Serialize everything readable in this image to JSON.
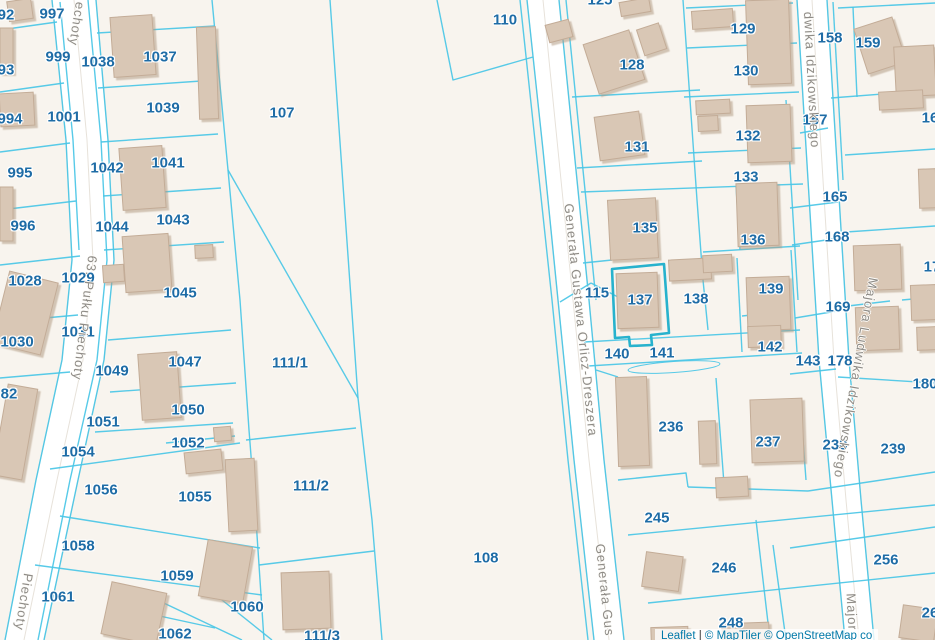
{
  "map": {
    "selected_parcel": "137",
    "colors": {
      "background": "#f8f4ee",
      "parcel_line": "#49c6e6",
      "selected_outline": "#27b2cd",
      "parcel_label": "#1e6ca6",
      "street_label": "#8e8b86",
      "building_fill": "#d9c7b5",
      "building_stroke": "#c3ac97",
      "road_fill": "#ffffff",
      "road_edge": "#d8d3cb"
    },
    "parcel_labels": [
      {
        "text": "92",
        "x": 6,
        "y": 15
      },
      {
        "text": "997",
        "x": 52,
        "y": 14
      },
      {
        "text": "999",
        "x": 58,
        "y": 57
      },
      {
        "text": "1038",
        "x": 98,
        "y": 62
      },
      {
        "text": "1037",
        "x": 160,
        "y": 57
      },
      {
        "text": "93",
        "x": 6,
        "y": 70
      },
      {
        "text": "1001",
        "x": 64,
        "y": 117
      },
      {
        "text": "994",
        "x": 10,
        "y": 119
      },
      {
        "text": "1039",
        "x": 163,
        "y": 108
      },
      {
        "text": "995",
        "x": 20,
        "y": 173
      },
      {
        "text": "1042",
        "x": 107,
        "y": 168
      },
      {
        "text": "1041",
        "x": 168,
        "y": 163
      },
      {
        "text": "996",
        "x": 23,
        "y": 226
      },
      {
        "text": "1044",
        "x": 112,
        "y": 227
      },
      {
        "text": "1043",
        "x": 173,
        "y": 220
      },
      {
        "text": "1028",
        "x": 25,
        "y": 281
      },
      {
        "text": "1029",
        "x": 78,
        "y": 278
      },
      {
        "text": "1045",
        "x": 180,
        "y": 293
      },
      {
        "text": "1030",
        "x": 17,
        "y": 342
      },
      {
        "text": "1031",
        "x": 78,
        "y": 332
      },
      {
        "text": "82",
        "x": 9,
        "y": 394
      },
      {
        "text": "1047",
        "x": 185,
        "y": 362
      },
      {
        "text": "1049",
        "x": 112,
        "y": 371
      },
      {
        "text": "1050",
        "x": 188,
        "y": 410
      },
      {
        "text": "1051",
        "x": 103,
        "y": 422
      },
      {
        "text": "1052",
        "x": 188,
        "y": 443
      },
      {
        "text": "1054",
        "x": 78,
        "y": 452
      },
      {
        "text": "1056",
        "x": 101,
        "y": 490
      },
      {
        "text": "1055",
        "x": 195,
        "y": 497
      },
      {
        "text": "1058",
        "x": 78,
        "y": 546
      },
      {
        "text": "1059",
        "x": 177,
        "y": 576
      },
      {
        "text": "1061",
        "x": 58,
        "y": 597
      },
      {
        "text": "1062",
        "x": 175,
        "y": 634
      },
      {
        "text": "1060",
        "x": 247,
        "y": 607
      },
      {
        "text": "107",
        "x": 282,
        "y": 113
      },
      {
        "text": "111/1",
        "x": 290,
        "y": 363
      },
      {
        "text": "111/2",
        "x": 311,
        "y": 486
      },
      {
        "text": "111/3",
        "x": 322,
        "y": 636
      },
      {
        "text": "108",
        "x": 486,
        "y": 558
      },
      {
        "text": "110",
        "x": 505,
        "y": 20
      },
      {
        "text": "125",
        "x": 600,
        "y": 0
      },
      {
        "text": "128",
        "x": 632,
        "y": 65
      },
      {
        "text": "129",
        "x": 743,
        "y": 29
      },
      {
        "text": "130",
        "x": 746,
        "y": 71
      },
      {
        "text": "131",
        "x": 637,
        "y": 147
      },
      {
        "text": "132",
        "x": 748,
        "y": 136
      },
      {
        "text": "133",
        "x": 746,
        "y": 177
      },
      {
        "text": "135",
        "x": 645,
        "y": 228
      },
      {
        "text": "136",
        "x": 753,
        "y": 240
      },
      {
        "text": "115",
        "x": 597,
        "y": 293
      },
      {
        "text": "137",
        "x": 640,
        "y": 300
      },
      {
        "text": "138",
        "x": 696,
        "y": 299
      },
      {
        "text": "139",
        "x": 771,
        "y": 289
      },
      {
        "text": "140",
        "x": 617,
        "y": 354
      },
      {
        "text": "141",
        "x": 662,
        "y": 353
      },
      {
        "text": "142",
        "x": 770,
        "y": 347
      },
      {
        "text": "143",
        "x": 808,
        "y": 361
      },
      {
        "text": "178",
        "x": 840,
        "y": 361
      },
      {
        "text": "180",
        "x": 925,
        "y": 384
      },
      {
        "text": "157",
        "x": 815,
        "y": 120
      },
      {
        "text": "158",
        "x": 830,
        "y": 38
      },
      {
        "text": "159",
        "x": 868,
        "y": 43
      },
      {
        "text": "165",
        "x": 835,
        "y": 197
      },
      {
        "text": "168",
        "x": 837,
        "y": 237
      },
      {
        "text": "169",
        "x": 838,
        "y": 307
      },
      {
        "text": "16",
        "x": 930,
        "y": 118
      },
      {
        "text": "17",
        "x": 932,
        "y": 267
      },
      {
        "text": "236",
        "x": 671,
        "y": 427
      },
      {
        "text": "237",
        "x": 768,
        "y": 442
      },
      {
        "text": "238",
        "x": 835,
        "y": 445
      },
      {
        "text": "239",
        "x": 893,
        "y": 449
      },
      {
        "text": "245",
        "x": 657,
        "y": 518
      },
      {
        "text": "246",
        "x": 724,
        "y": 568
      },
      {
        "text": "248",
        "x": 731,
        "y": 623
      },
      {
        "text": "256",
        "x": 886,
        "y": 560
      },
      {
        "text": "26",
        "x": 930,
        "y": 613
      }
    ],
    "street_labels": [
      {
        "text": "echoty",
        "x": 77,
        "y": 24,
        "rot": 99
      },
      {
        "text": "63. Pułku Piechoty",
        "x": 85,
        "y": 318,
        "rot": 97
      },
      {
        "text": "Piechoty",
        "x": 24,
        "y": 602,
        "rot": 99
      },
      {
        "text": "Generała Gustawa Orlicz-Dreszera",
        "x": 581,
        "y": 320,
        "rot": 84
      },
      {
        "text": "Generała Gus",
        "x": 605,
        "y": 590,
        "rot": 84
      },
      {
        "text": "dwika Idzikowskiego",
        "x": 812,
        "y": 80,
        "rot": 87
      },
      {
        "text": "Majora Ludwika Idzikowskiego",
        "x": 856,
        "y": 378,
        "rot": 100
      },
      {
        "text": "Major",
        "x": 852,
        "y": 612,
        "rot": 87
      }
    ],
    "attribution": {
      "leaflet": "Leaflet",
      "separator": " | ",
      "tiles": "© MapTiler © OpenStreetMap co"
    }
  }
}
